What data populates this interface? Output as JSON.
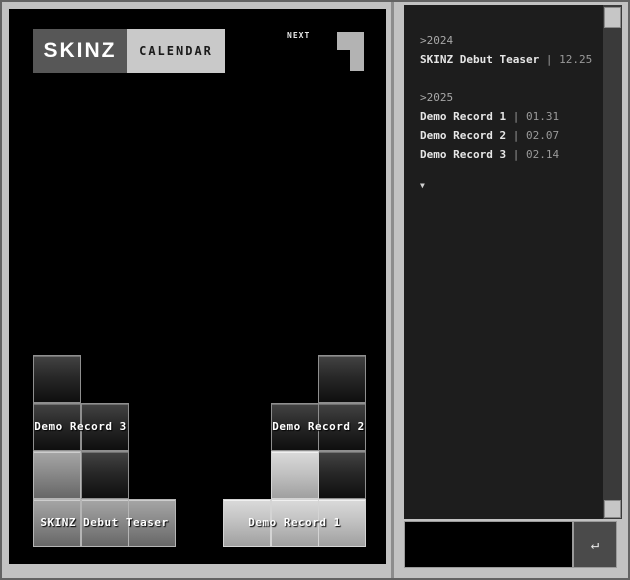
{
  "window": {
    "brand": "SKINZ",
    "view": "CALENDAR",
    "next_label": "NEXT"
  },
  "board": {
    "next_piece_shape": "J",
    "pieces": [
      {
        "id": "demo-record-3",
        "shade": "dark",
        "cells": [
          [
            0,
            0
          ],
          [
            0,
            1
          ],
          [
            1,
            1
          ],
          [
            1,
            2
          ]
        ],
        "label": "Demo Record 3",
        "label_span": {
          "col": 0,
          "row": 1,
          "cols": 2
        }
      },
      {
        "id": "skinz-debut-teaser",
        "shade": "mid",
        "cells": [
          [
            0,
            2
          ],
          [
            0,
            3
          ],
          [
            1,
            3
          ],
          [
            2,
            3
          ]
        ],
        "label": "SKINZ Debut Teaser",
        "label_span": {
          "col": 0,
          "row": 3,
          "cols": 3
        }
      },
      {
        "id": "demo-record-2",
        "shade": "dark",
        "cells": [
          [
            6,
            0
          ],
          [
            5,
            1
          ],
          [
            6,
            1
          ],
          [
            6,
            2
          ]
        ],
        "label": "Demo Record 2",
        "label_span": {
          "col": 5,
          "row": 1,
          "cols": 2
        }
      },
      {
        "id": "demo-record-1",
        "shade": "light",
        "cells": [
          [
            5,
            2
          ],
          [
            4,
            3
          ],
          [
            5,
            3
          ],
          [
            6,
            3
          ]
        ],
        "label": "Demo Record 1",
        "label_span": {
          "col": 4,
          "row": 3,
          "cols": 3
        }
      }
    ]
  },
  "timeline": {
    "groups": [
      {
        "year": ">2024",
        "entries": [
          {
            "name": "SKINZ Debut Teaser",
            "separator": "|",
            "date": "12.25"
          }
        ]
      },
      {
        "year": ">2025",
        "entries": [
          {
            "name": "Demo Record 1",
            "separator": "|",
            "date": "01.31"
          },
          {
            "name": "Demo Record 2",
            "separator": "|",
            "date": "02.07"
          },
          {
            "name": "Demo Record 3",
            "separator": "|",
            "date": "02.14"
          }
        ]
      }
    ],
    "more_indicator": "▼"
  },
  "composer": {
    "input_value": "",
    "enter_icon": "↵"
  },
  "colors": {
    "frame": "#c2c2c2",
    "screen_bg": "#000000",
    "panel_bg": "#1d1d1d",
    "block_dark_top": "#434343",
    "block_dark_bottom": "#0f0f0f",
    "block_mid_top": "#a6a6a6",
    "block_mid_bottom": "#676767",
    "block_light_top": "#dadada",
    "block_light_bottom": "#a0a0a0"
  }
}
